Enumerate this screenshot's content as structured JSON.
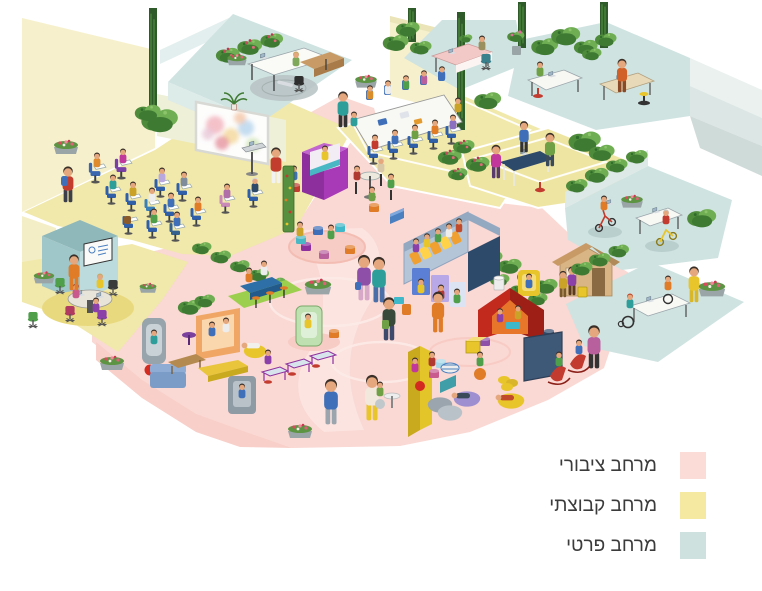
{
  "legend": {
    "items": [
      {
        "id": "public-space",
        "label": "מרחב ציבורי",
        "color": "#FBDCD7"
      },
      {
        "id": "group-space",
        "label": "מרחב קבוצתי",
        "color": "#F5E8A1"
      },
      {
        "id": "private-space",
        "label": "מרחב פרטי",
        "color": "#CEE1DE"
      }
    ]
  },
  "palette": {
    "public_floor": "#FAD8D3",
    "group_floor": "#F1E8AB",
    "private_floor": "#CFE3E1"
  }
}
